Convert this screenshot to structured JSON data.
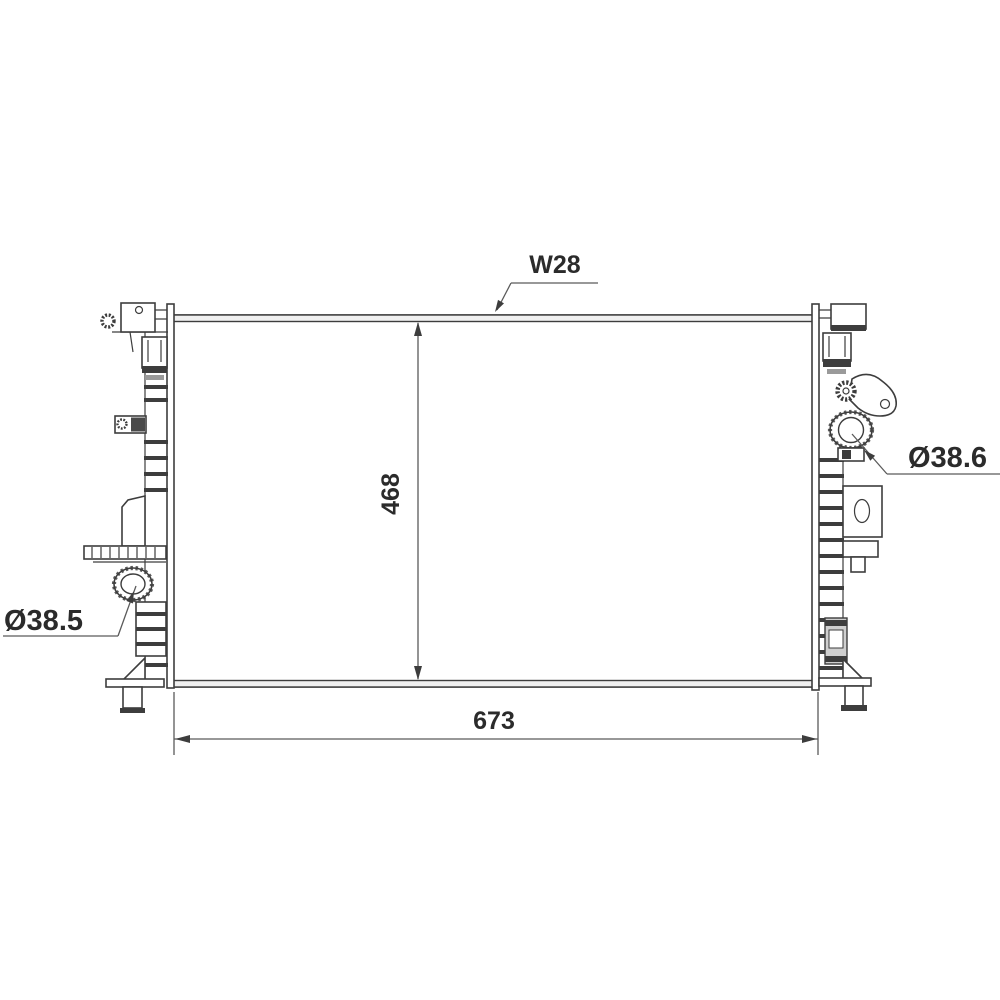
{
  "page": {
    "background_color": "#ffffff"
  },
  "drawing": {
    "subject": "radiator-front-view-technical-drawing",
    "line_color": "#3d3d3d",
    "dimension_line_color": "#5a5a5a",
    "text_color": "#2b2b2b",
    "labels": {
      "top_width": "W28",
      "core_height": "468",
      "core_width": "673",
      "left_port_diameter": "Ø38.5",
      "right_port_diameter": "Ø38.6"
    }
  }
}
